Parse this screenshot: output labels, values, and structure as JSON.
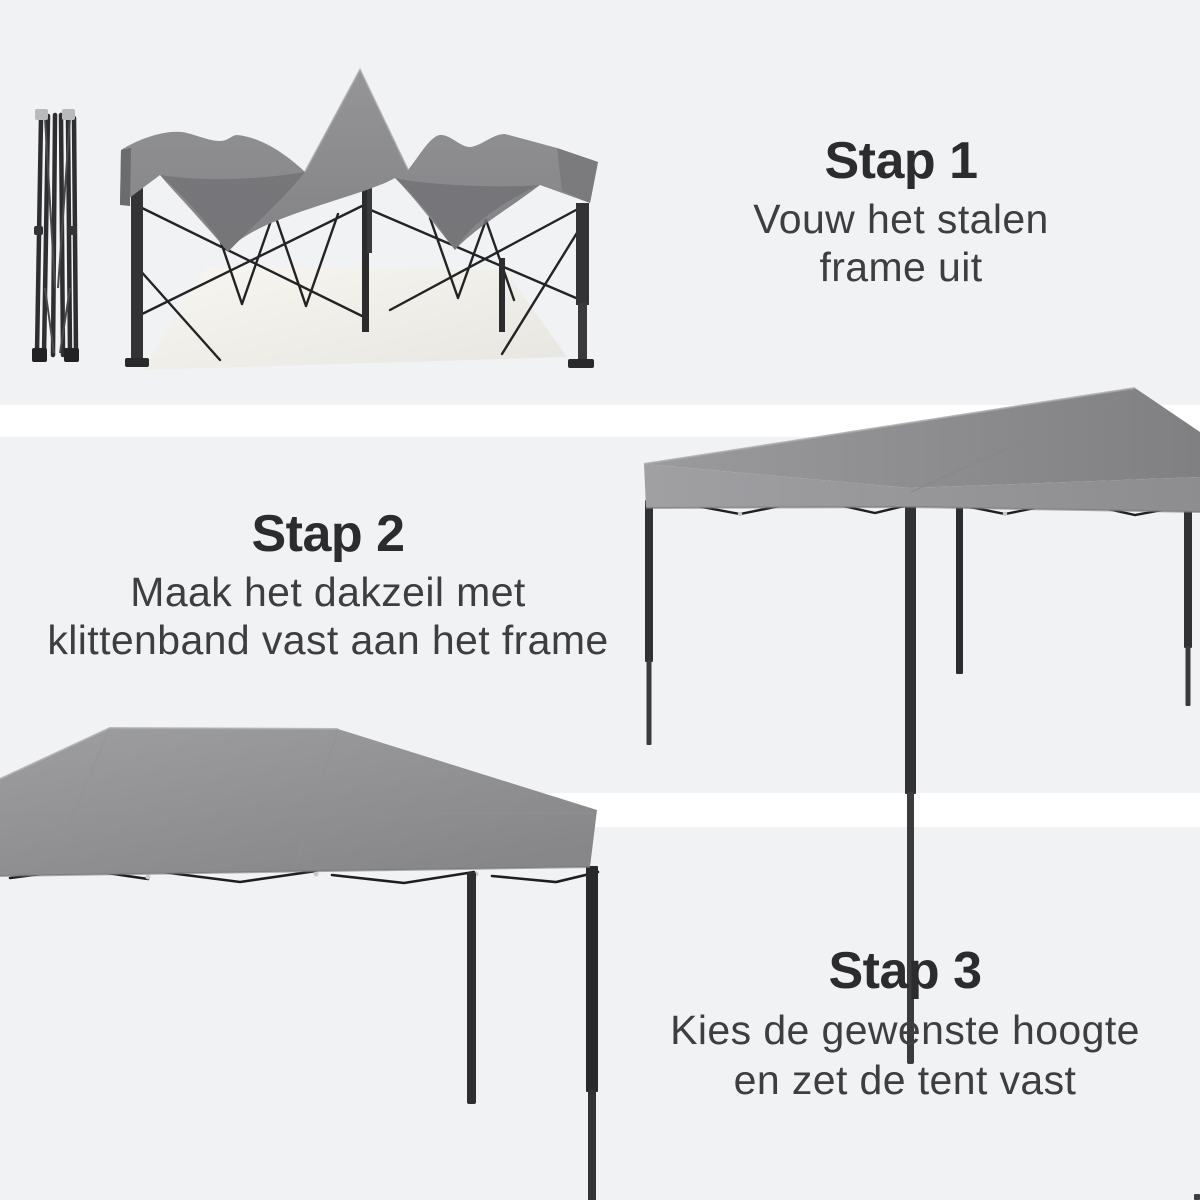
{
  "page": {
    "width": 1200,
    "height": 1200,
    "background_color": "#f1f2f4",
    "divider_color": "#ffffff",
    "language": "nl"
  },
  "colors": {
    "heading_text": "#2c2c2e",
    "body_text": "#3e3e41",
    "canopy_light": "#9b9b9e",
    "canopy_mid": "#8b8b8e",
    "canopy_dark": "#737377",
    "frame_dark": "#303032",
    "metal_silver": "#c0c0c3",
    "floor_cream": "#f0efe9"
  },
  "steps": [
    {
      "id": 1,
      "title": "Stap 1",
      "lines": [
        "Vouw het stalen",
        "frame uit"
      ],
      "image": "folded-steel-frame-and-opened-frame-with-loose-canvas"
    },
    {
      "id": 2,
      "title": "Stap 2",
      "lines": [
        "Maak het dakzeil met",
        "klittenband vast aan het frame"
      ],
      "image": "assembled-gazebo-with-canopy"
    },
    {
      "id": 3,
      "title": "Stap 3",
      "lines": [
        "Kies de gewenste hoogte",
        "en zet de tent vast"
      ],
      "image": "canopy-closeup-with-extended-legs"
    }
  ]
}
